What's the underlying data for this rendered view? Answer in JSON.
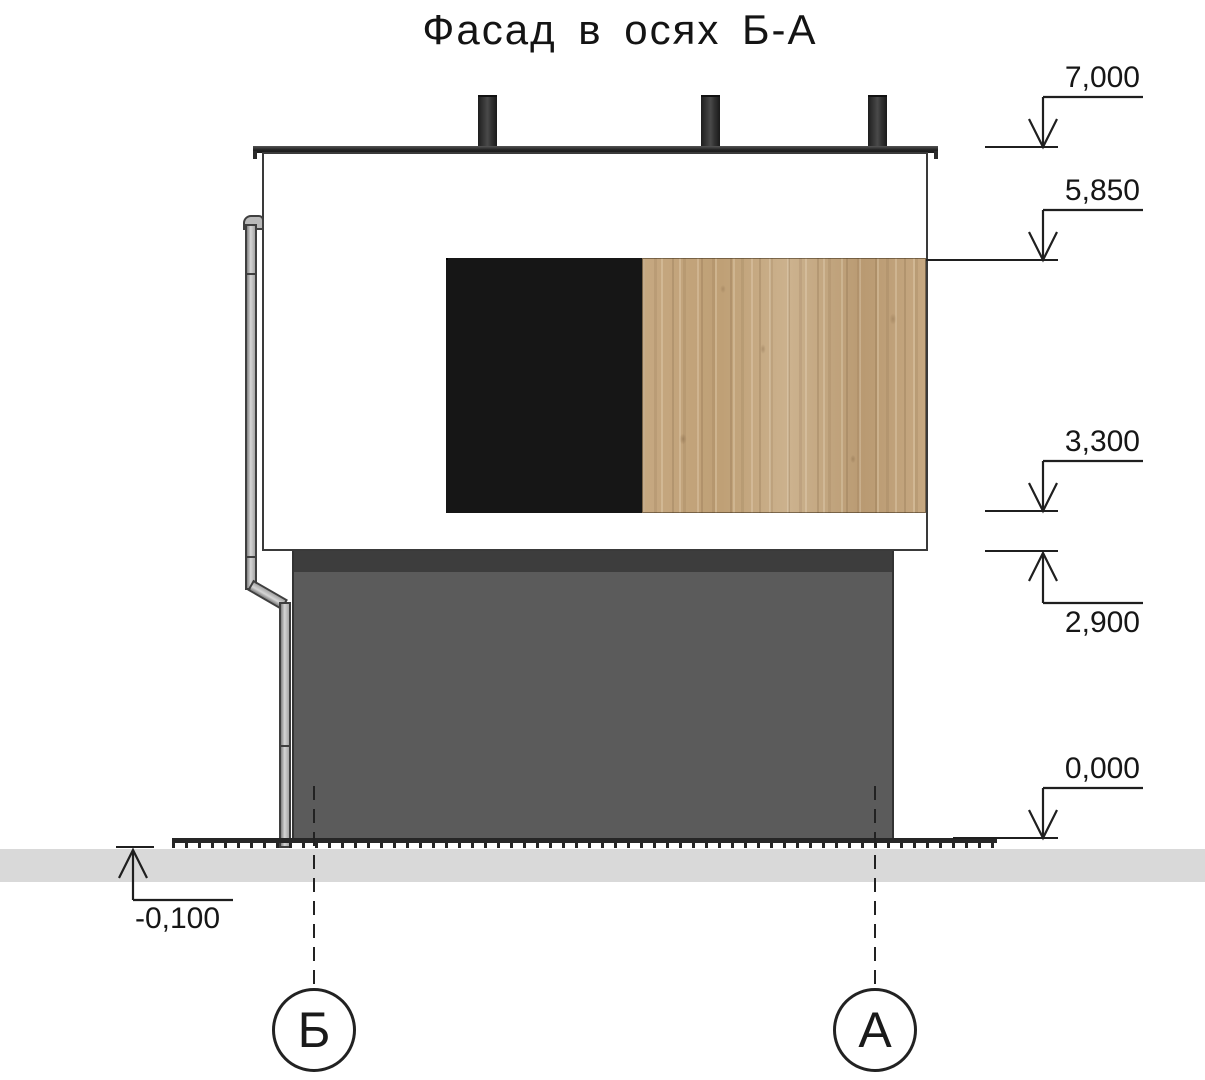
{
  "title": "Фасад в осях Б-А",
  "drawing": {
    "levels": [
      {
        "name": "parapet",
        "value": "7,000",
        "direction": "down"
      },
      {
        "name": "window-head",
        "value": "5,850",
        "direction": "down"
      },
      {
        "name": "slab-top",
        "value": "3,300",
        "direction": "down"
      },
      {
        "name": "floor1-ceiling",
        "value": "2,900",
        "direction": "up"
      },
      {
        "name": "ground-floor",
        "value": "0,000",
        "direction": "down"
      },
      {
        "name": "grade",
        "value": "-0,100",
        "direction": "up"
      }
    ],
    "axes": [
      {
        "label": "Б"
      },
      {
        "label": "А"
      }
    ],
    "colors": {
      "upper_wall": "#ffffff",
      "lower_wall": "#5b5b5b",
      "lower_wall_band": "#3d3d3d",
      "wood": "#c2a47e",
      "window_frame": "#161616",
      "glass": "#eef3ee",
      "ground": "#d9d9d9",
      "line": "#1f1f1f"
    }
  }
}
